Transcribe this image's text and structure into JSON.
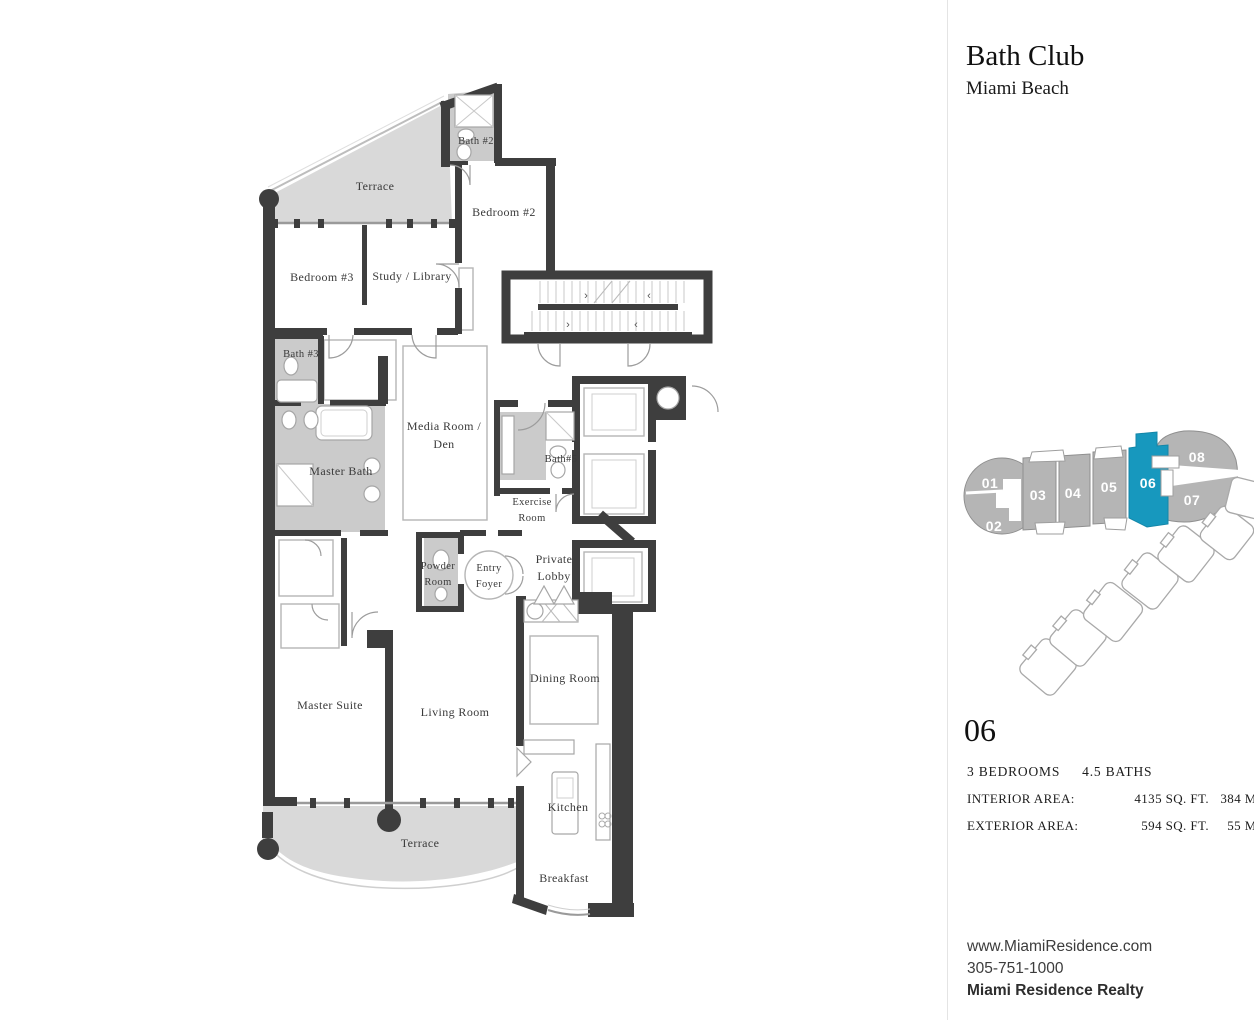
{
  "header": {
    "title": "Bath Club",
    "subtitle": "Miami Beach"
  },
  "floorplan": {
    "rooms": {
      "terrace_top": "Terrace",
      "bath_2": "Bath #2",
      "bedroom_2": "Bedroom #2",
      "bedroom_3": "Bedroom #3",
      "study": "Study / Library",
      "bath_3": "Bath #3",
      "media_1": "Media Room /",
      "media_2": "Den",
      "master_bath": "Master Bath",
      "bath_5": "Bath#5",
      "exercise_1": "Exercise",
      "exercise_2": "Room",
      "powder_1": "Powder",
      "powder_2": "Room",
      "entry_1": "Entry",
      "entry_2": "Foyer",
      "lobby_1": "Private",
      "lobby_2": "Lobby",
      "master_suite": "Master Suite",
      "living_room": "Living Room",
      "dining_room": "Dining Room",
      "kitchen": "Kitchen",
      "breakfast": "Breakfast",
      "terrace_bottom": "Terrace"
    }
  },
  "keyplan": {
    "units": [
      "01",
      "02",
      "03",
      "04",
      "05",
      "06",
      "07",
      "08"
    ],
    "highlighted_unit": "06",
    "highlight_color": "#1798be",
    "unit_color": "#b5b5b5"
  },
  "unit_info": {
    "number": "06",
    "bedrooms": "3 BEDROOMS",
    "baths": "4.5 BATHS",
    "rows": [
      {
        "label": "INTERIOR AREA:",
        "sqft": "4135 SQ. FT.",
        "m2": "384 M²"
      },
      {
        "label": "EXTERIOR AREA:",
        "sqft": "594 SQ. FT.",
        "m2": "55 M²"
      }
    ]
  },
  "footer": {
    "website": "www.MiamiResidence.com",
    "phone": "305-751-1000",
    "company": "Miami Residence Realty"
  },
  "colors": {
    "wall": "#3e3e3e",
    "terrace": "#d9d9d9",
    "bath": "#cbcbcb"
  }
}
